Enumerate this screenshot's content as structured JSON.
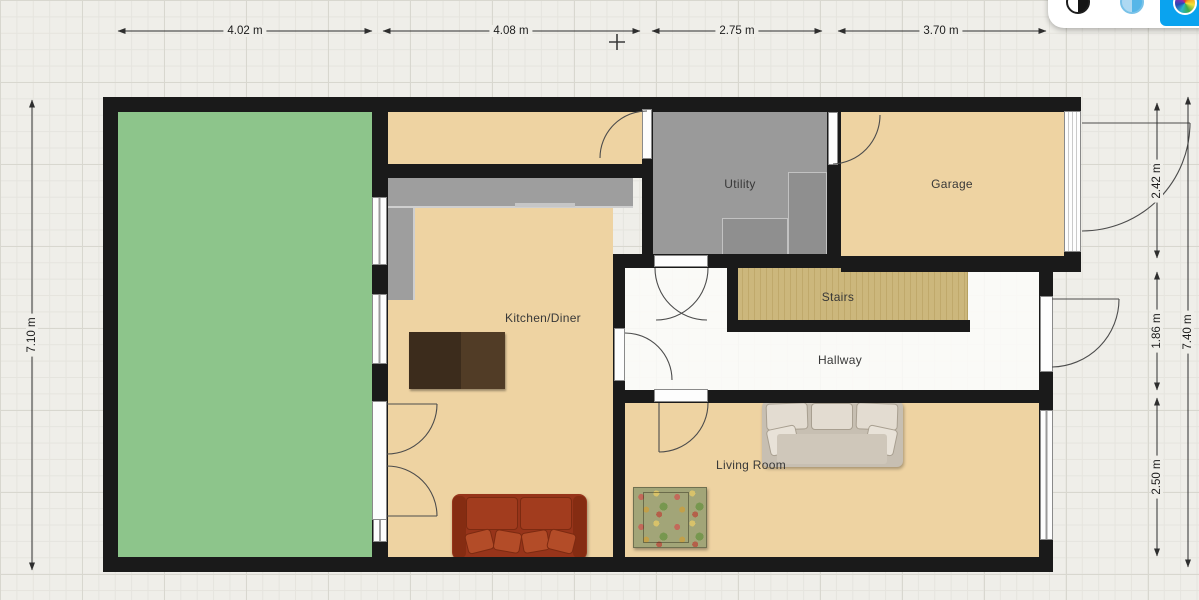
{
  "toolbar": {
    "style_options": [
      {
        "name": "monochrome-style",
        "selected": false
      },
      {
        "name": "blue-style",
        "selected": false
      },
      {
        "name": "color-style",
        "selected": true
      }
    ],
    "selected_bg_color": "#0aa3ef"
  },
  "rooms": {
    "utility": {
      "label": "Utility"
    },
    "garage": {
      "label": "Garage"
    },
    "kitchen": {
      "label": "Kitchen/Diner"
    },
    "stairs": {
      "label": "Stairs"
    },
    "hallway": {
      "label": "Hallway"
    },
    "living_room": {
      "label": "Living Room"
    }
  },
  "dimensions": {
    "top": [
      {
        "label": "4.02 m"
      },
      {
        "label": "4.08 m"
      },
      {
        "label": "2.75 m"
      },
      {
        "label": "3.70 m"
      }
    ],
    "left": [
      {
        "label": "7.10 m"
      }
    ],
    "right": [
      {
        "label": "2.42 m"
      },
      {
        "label": "1.86 m"
      },
      {
        "label": "2.50 m"
      },
      {
        "label": "7.40 m"
      }
    ]
  },
  "furniture": [
    {
      "name": "kitchen-counter"
    },
    {
      "name": "utility-counter"
    },
    {
      "name": "dining-table"
    },
    {
      "name": "red-sofa"
    },
    {
      "name": "beige-sofa"
    },
    {
      "name": "floral-armchair"
    }
  ],
  "colors": {
    "wall": "#1a1a1a",
    "floor_tan": "#eed3a2",
    "floor_gray": "#9a9a9a",
    "garden_green": "#8dc58b",
    "stairs_wood": "#ccb77c"
  }
}
